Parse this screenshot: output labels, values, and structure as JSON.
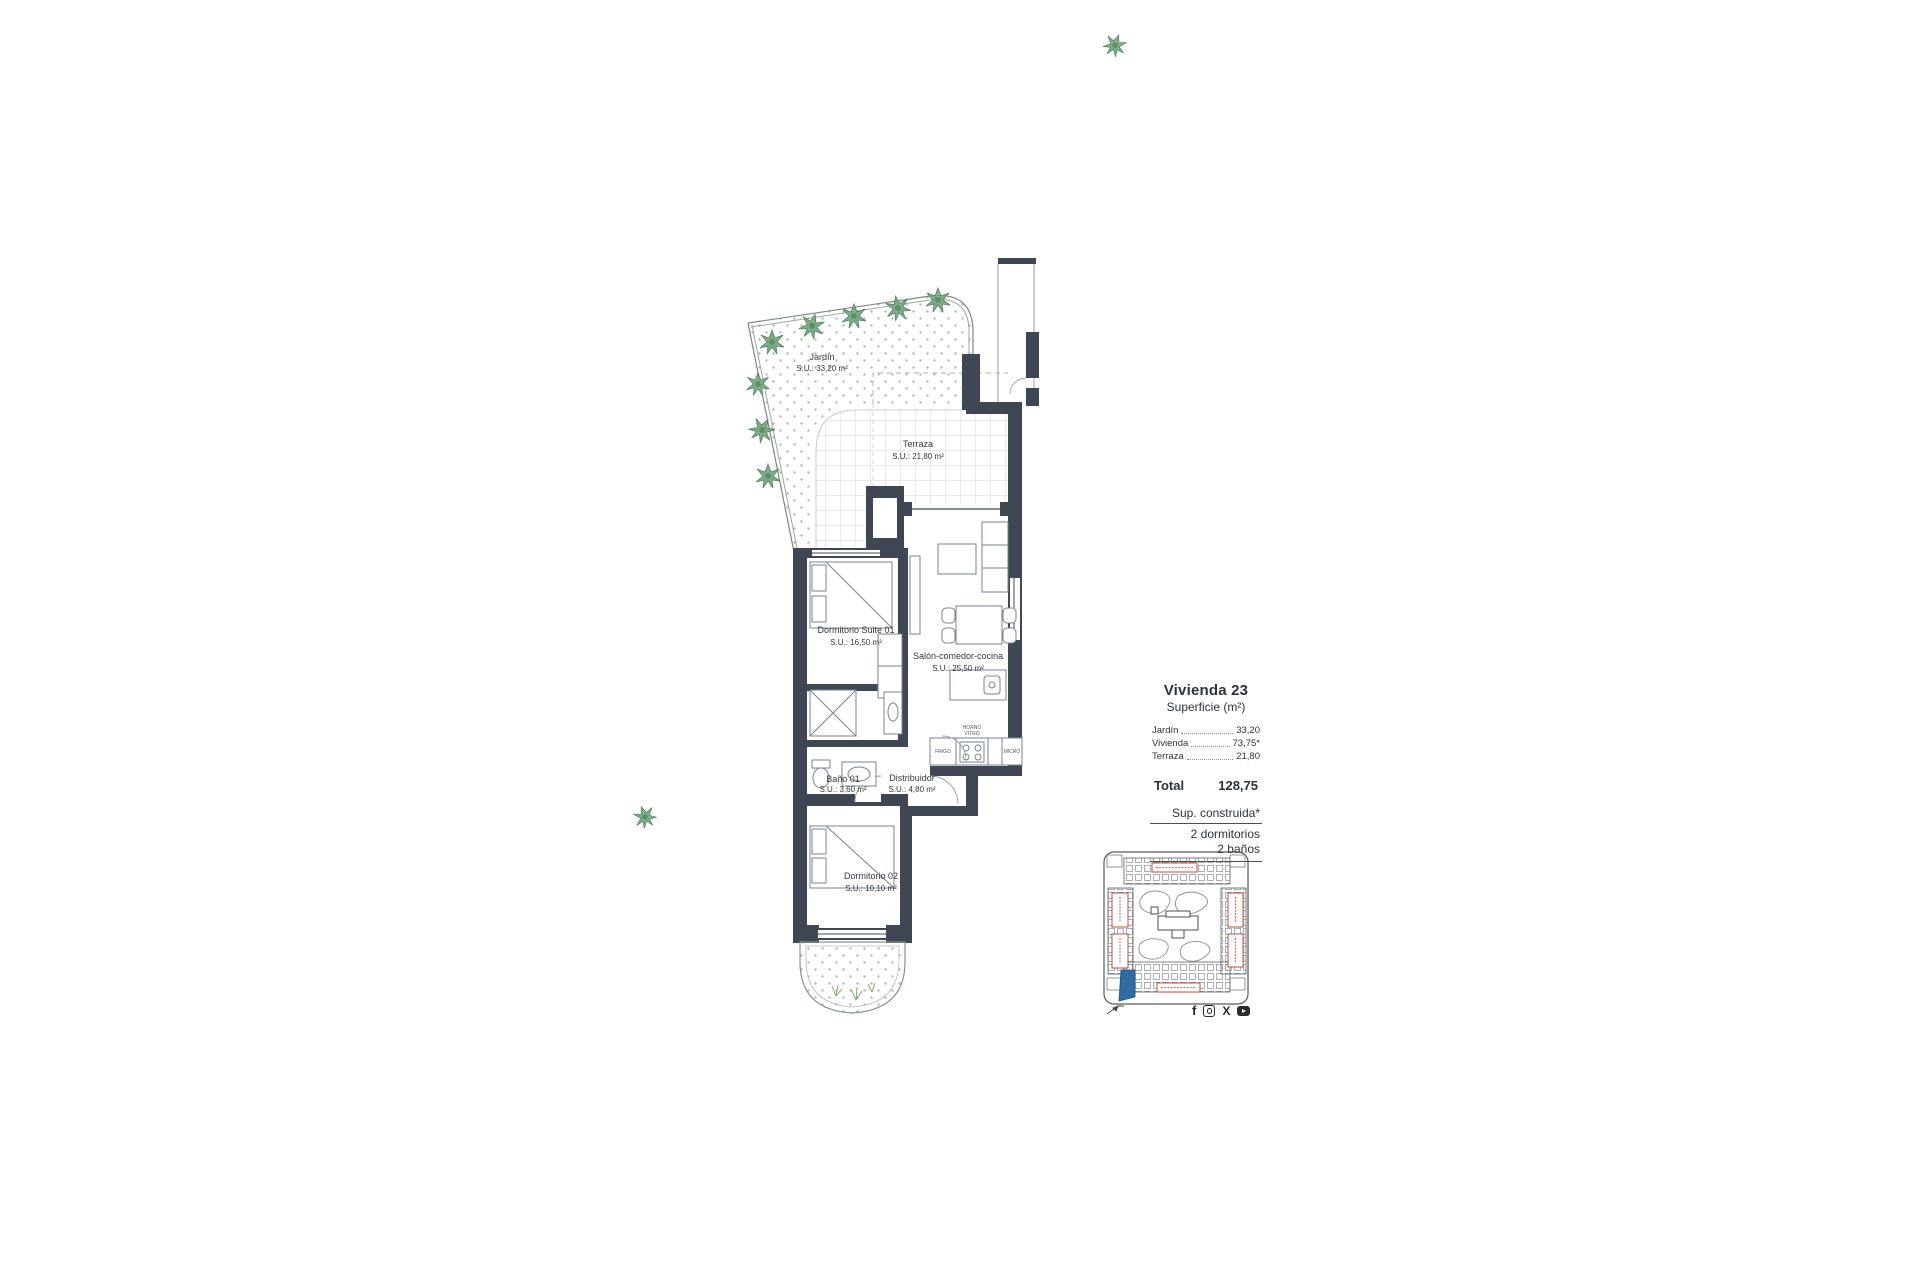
{
  "floor_plan": {
    "rooms": {
      "jardin": {
        "name": "Jardín",
        "area": "S.U.: 33,20 m²"
      },
      "terraza": {
        "name": "Terraza",
        "area": "S.U.: 21,80 m²"
      },
      "suite": {
        "name": "Dormitorio Suite 01",
        "area": "S.U.: 16,50 m²"
      },
      "salon": {
        "name": "Salón-comedor-cocina",
        "area": "S.U.: 25,50 m²"
      },
      "bano1": {
        "name": "Baño 01",
        "area": "S.U.: 3,60 m²"
      },
      "distribuidor": {
        "name": "Distribuidor",
        "area": "S.U.: 4,80 m²"
      },
      "dormitorio2": {
        "name": "Dormitorio 02",
        "area": "S.U.: 10,10 m²"
      }
    },
    "kitchen_labels": {
      "fridge": "FRIGO",
      "oven_top": "HORNO",
      "oven_bottom": "VITRO",
      "micro": "MICRO"
    }
  },
  "legend": {
    "title": "Vivienda 23",
    "subtitle": "Superficie (m²)",
    "items": [
      {
        "label": "Jardín",
        "value": "33,20"
      },
      {
        "label": "Vivienda",
        "value": "73,75*"
      },
      {
        "label": "Terraza",
        "value": "21,80"
      }
    ],
    "total_label": "Total",
    "total_value": "128,75",
    "notes": [
      "Sup. construida*",
      "2 dormitorios",
      "2 baños"
    ]
  },
  "colors": {
    "wall": "#3e4753",
    "furniture_line": "#7a8290",
    "tile_line": "#d2d6db",
    "garden_dot": "#9fc0a5",
    "tree": "#7aa884",
    "tree_edge": "#4e7d5c",
    "site_line": "#666b70",
    "site_label_red": "#c0392b",
    "unit_highlight_blue": "#2e6da4"
  },
  "social": {
    "facebook": "f",
    "x": "X"
  }
}
